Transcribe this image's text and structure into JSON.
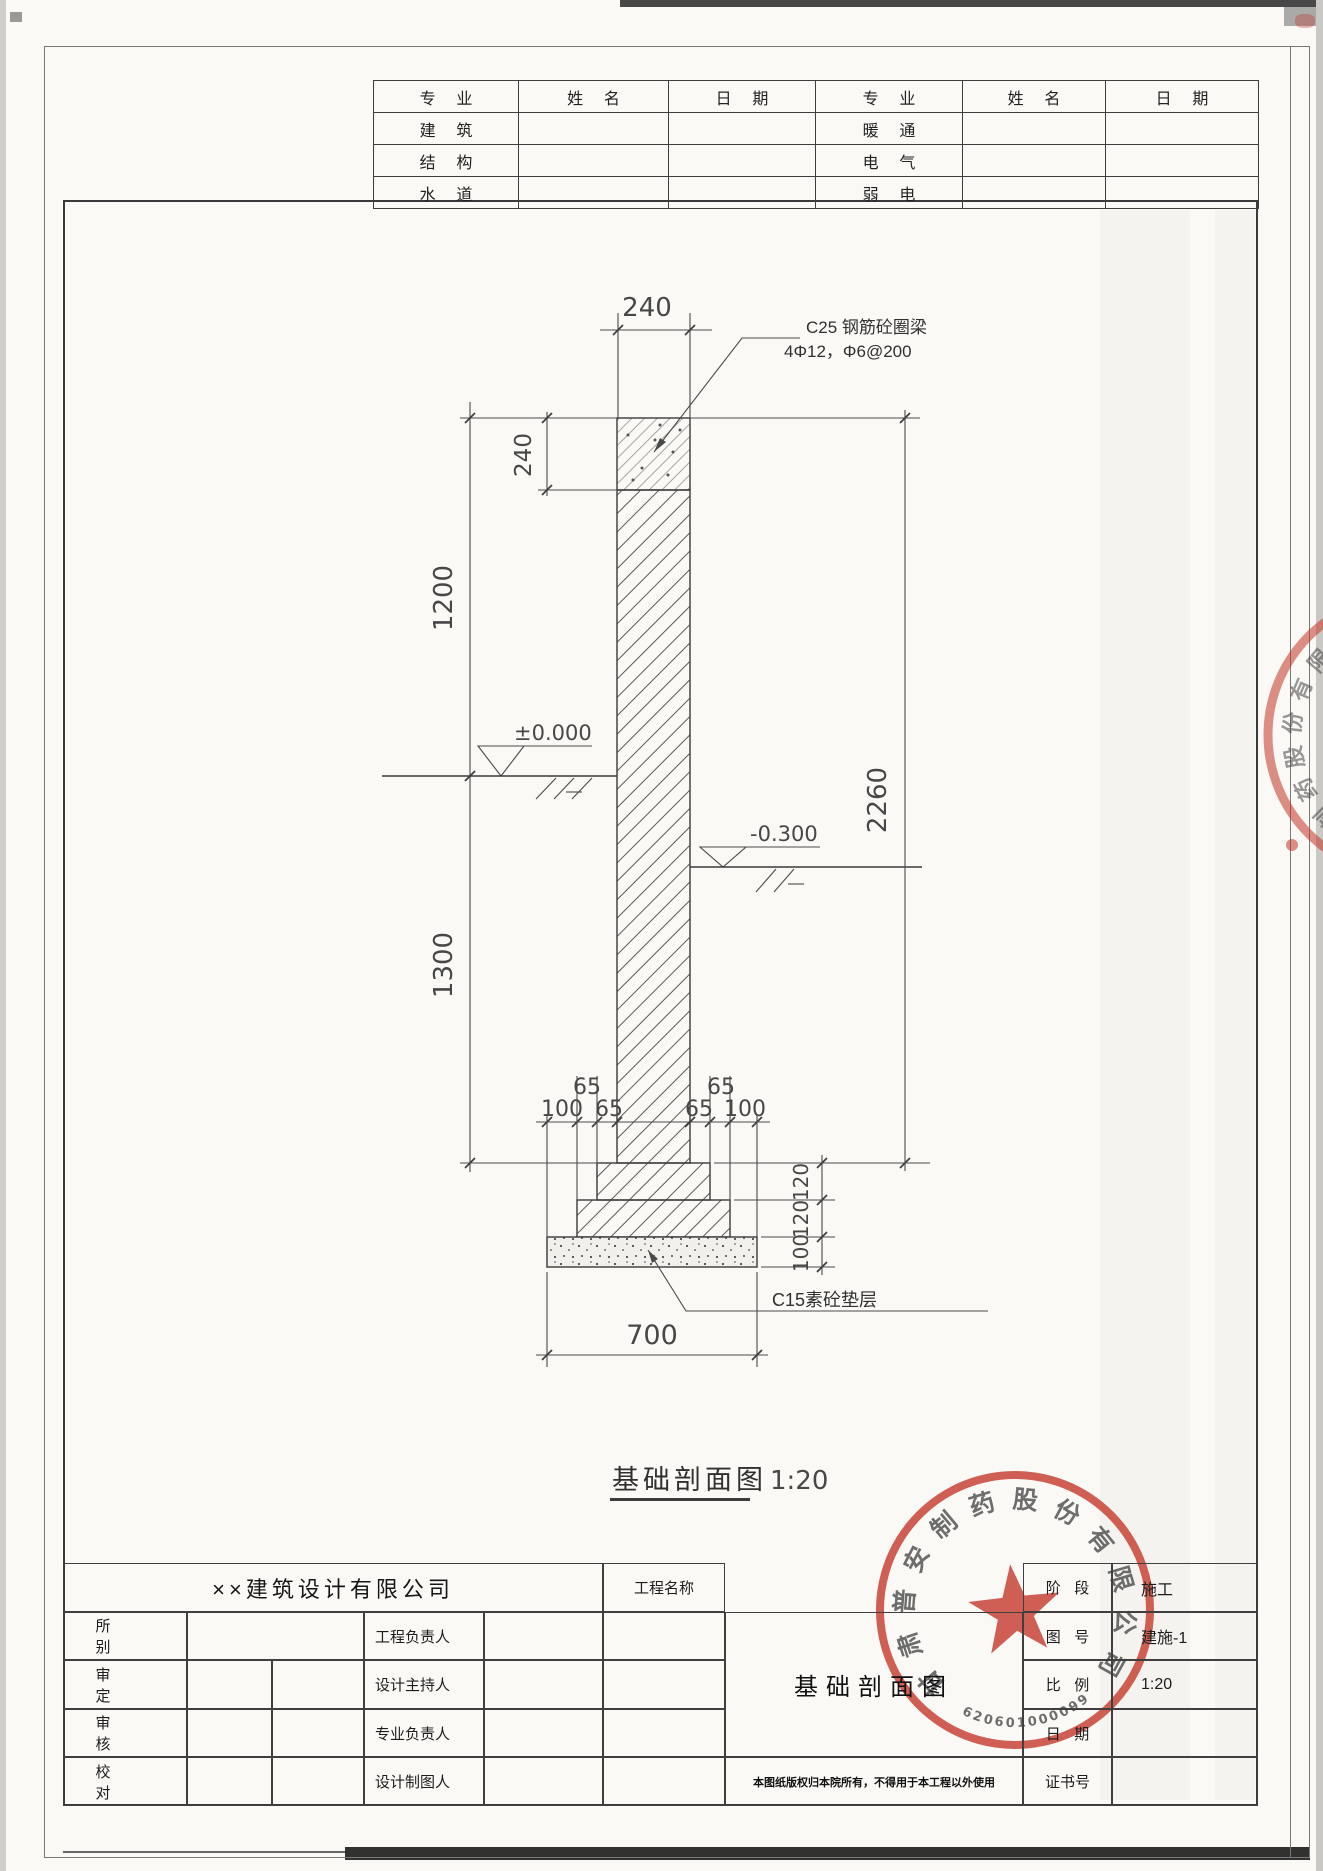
{
  "colors": {
    "stamp_red": "#c43527",
    "line": "#3a3a3a",
    "paper": "#faf9f6"
  },
  "signature_table": {
    "headers": [
      "专业",
      "姓名",
      "日期",
      "专业",
      "姓名",
      "日期"
    ],
    "rows": [
      {
        "left": "建筑",
        "right": "暖通"
      },
      {
        "left": "结构",
        "right": "电气"
      },
      {
        "left": "水道",
        "right": "弱电"
      }
    ]
  },
  "drawing": {
    "caption_title": "基础剖面图",
    "caption_scale": "1:20",
    "annotations": {
      "ring_beam_label": "C25 钢筋砼圈梁",
      "ring_beam_rebar": "4Φ12，Φ6@200",
      "cushion_label": "C15素砼垫层",
      "level_zero": "±0.000",
      "level_minus300": "-0.300"
    },
    "dimensions": {
      "wall_width": "240",
      "ring_beam_height": "240",
      "above_ground_height": "1200",
      "below_ground_depth": "1300",
      "overall_height": "2260",
      "base_width": "700",
      "left_steps": {
        "outer": "100",
        "mid": "65",
        "inner": "65"
      },
      "right_steps": {
        "inner": "65",
        "mid": "65",
        "outer": "100"
      },
      "step_heights": {
        "first": "120",
        "second": "120",
        "cushion": "100"
      }
    }
  },
  "title_block": {
    "company": "××建筑设计有限公司",
    "project_name_label": "工程名称",
    "left_rows": [
      {
        "label": "所别",
        "label2": "工程负责人"
      },
      {
        "label": "审定",
        "label2": "设计主持人"
      },
      {
        "label": "审核",
        "label2": "专业负责人"
      },
      {
        "label": "校对",
        "label2": "设计制图人"
      }
    ],
    "drawing_title": "基础剖面图",
    "note": "本图纸版权归本院所有，不得用于本工程以外使用",
    "right_rows": [
      {
        "label": "阶段",
        "value": "施工"
      },
      {
        "label": "图号",
        "value": "建施-1"
      },
      {
        "label": "比例",
        "value": "1:20"
      },
      {
        "label": "日期",
        "value": ""
      },
      {
        "label": "证书号",
        "value": ""
      }
    ]
  },
  "stamps": {
    "main": {
      "company": "甘肃普安制药股份有限公司",
      "number": "620601000099"
    },
    "edge": {
      "visible_chars": "制药股份有限"
    }
  }
}
